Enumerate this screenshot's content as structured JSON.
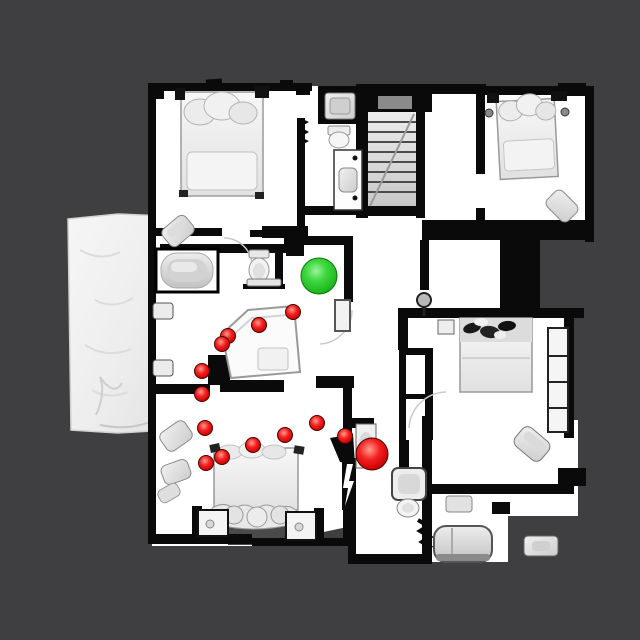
{
  "scene": {
    "background_color": "#3f3f41",
    "floor_color": "#ffffff",
    "wall_color": "#0a0a0a",
    "furniture_color": "#e4e4e4"
  },
  "markers": {
    "goal": {
      "x": 319,
      "y": 276,
      "r": 18,
      "color": "#2ecc2e"
    },
    "agent": {
      "x": 372,
      "y": 454,
      "r": 16,
      "color": "#e31515"
    },
    "waypoints": {
      "r": 7.5,
      "color": "#e31515",
      "points": [
        [
          293,
          312
        ],
        [
          259,
          325
        ],
        [
          228,
          336
        ],
        [
          222,
          344
        ],
        [
          202,
          371
        ],
        [
          202,
          394
        ],
        [
          205,
          428
        ],
        [
          206,
          463
        ],
        [
          222,
          457
        ],
        [
          253,
          445
        ],
        [
          285,
          435
        ],
        [
          317,
          423
        ],
        [
          345,
          436
        ]
      ]
    }
  }
}
